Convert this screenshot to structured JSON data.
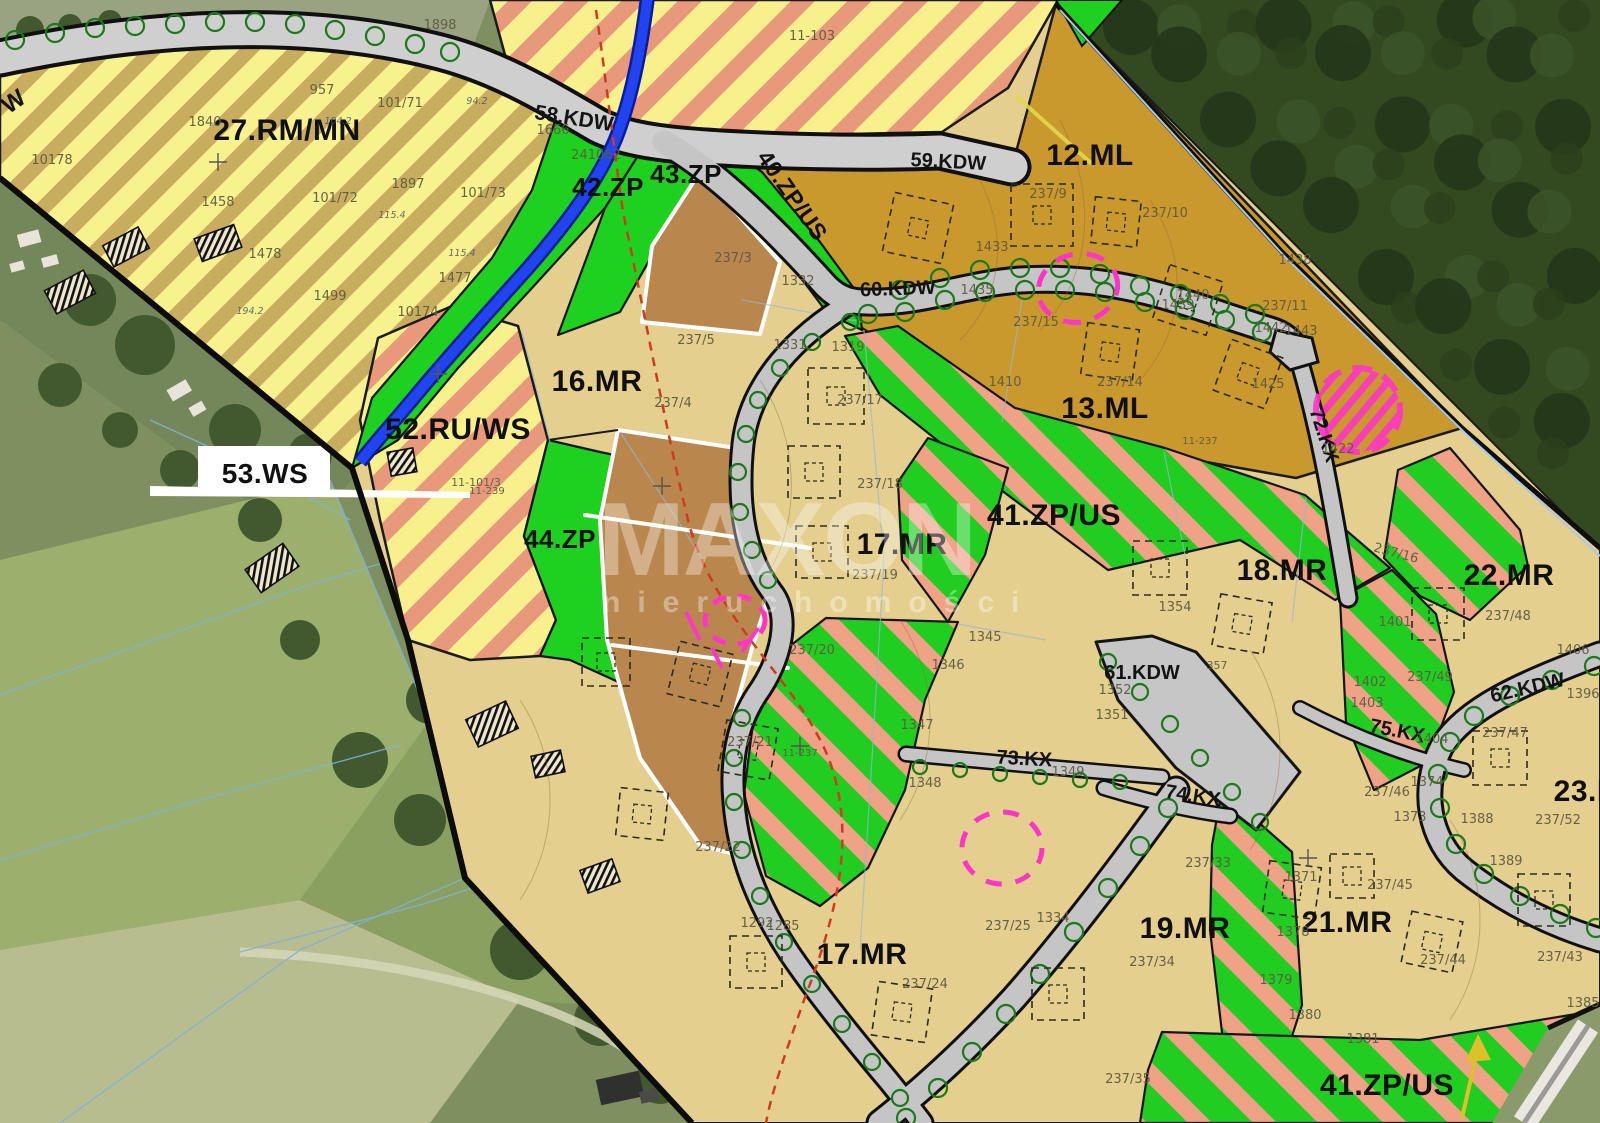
{
  "map_title": "zoning-plan-over-orthophoto",
  "watermark": {
    "line1": "MAXON",
    "line2": "nieruchomości"
  },
  "colors": {
    "zone_green": "#1fd11f",
    "stripe_salmon": "#efa285",
    "zone_yellow": "#f8f28e",
    "stripe_tan": "#c9ad5f",
    "zone_tan_mr": "#e4cf8f",
    "zone_goldenrod_ml": "#c9992e",
    "parcel_brown": "#b9874e",
    "road_gray": "#c5c5c5",
    "stream_blue": "#2244f0",
    "highlight_magenta": "#ff35c8",
    "forest_green": "#33491f",
    "boundary_black": "#0c0c0c"
  },
  "zone_labels": [
    {
      "id": "zone-27-rm-mn",
      "text": "27.RM/MN",
      "x": 287,
      "y": 140,
      "size": 30
    },
    {
      "id": "zone-12-ml",
      "text": "12.ML",
      "x": 1090,
      "y": 165,
      "size": 30
    },
    {
      "id": "zone-13-ml",
      "text": "13.ML",
      "x": 1105,
      "y": 418,
      "size": 30
    },
    {
      "id": "zone-16-mr",
      "text": "16.MR",
      "x": 597,
      "y": 391,
      "size": 30
    },
    {
      "id": "zone-17-mr",
      "text": "17.MR",
      "x": 902,
      "y": 554,
      "size": 30
    },
    {
      "id": "zone-17-mr-2",
      "text": "17.MR",
      "x": 862,
      "y": 964,
      "size": 30
    },
    {
      "id": "zone-18-mr",
      "text": "18.MR",
      "x": 1282,
      "y": 580,
      "size": 30
    },
    {
      "id": "zone-19-mr",
      "text": "19.MR",
      "x": 1185,
      "y": 938,
      "size": 30
    },
    {
      "id": "zone-21-mr",
      "text": "21.MR",
      "x": 1347,
      "y": 932,
      "size": 30
    },
    {
      "id": "zone-22-mr",
      "text": "22.MR",
      "x": 1509,
      "y": 585,
      "size": 30
    },
    {
      "id": "zone-23-m",
      "text": "23.M",
      "x": 1588,
      "y": 801,
      "size": 30
    },
    {
      "id": "zone-41-zp-us",
      "text": "41.ZP/US",
      "x": 1054,
      "y": 525,
      "size": 30
    },
    {
      "id": "zone-41-zp-us-2",
      "text": "41.ZP/US",
      "x": 1387,
      "y": 1095,
      "size": 30
    },
    {
      "id": "zone-42-zp",
      "text": "42.ZP",
      "x": 608,
      "y": 196,
      "size": 26
    },
    {
      "id": "zone-43-zp",
      "text": "43.ZP",
      "x": 686,
      "y": 183,
      "size": 26
    },
    {
      "id": "zone-40-zp-us",
      "text": "40.ZP/US",
      "x": 786,
      "y": 200,
      "size": 23,
      "rot": 55
    },
    {
      "id": "zone-44-zp",
      "text": "44.ZP",
      "x": 560,
      "y": 548,
      "size": 26
    },
    {
      "id": "zone-52-ru-ws",
      "text": "52.RU/WS",
      "x": 458,
      "y": 439,
      "size": 30
    },
    {
      "id": "zone-53-ws",
      "text": "53.WS",
      "x": 265,
      "y": 483,
      "size": 28
    }
  ],
  "road_labels": [
    {
      "id": "road-58-kdw",
      "text": "58.KDW",
      "x": 573,
      "y": 125,
      "size": 21,
      "rot": 9
    },
    {
      "id": "road-59-kdw",
      "text": "59.KDW",
      "x": 948,
      "y": 168,
      "size": 20,
      "rot": 3
    },
    {
      "id": "road-60-kdw",
      "text": "60.KDW",
      "x": 898,
      "y": 295,
      "size": 20,
      "rot": -2
    },
    {
      "id": "road-61-kdw",
      "text": "61.KDW",
      "x": 1142,
      "y": 679,
      "size": 20
    },
    {
      "id": "road-62-kdw",
      "text": "62.KDW",
      "x": 1529,
      "y": 694,
      "size": 20,
      "rot": -13
    },
    {
      "id": "road-72-kx",
      "text": "72.KX",
      "x": 1318,
      "y": 437,
      "size": 20,
      "rot": 72
    },
    {
      "id": "road-73-kx",
      "text": "73.KX",
      "x": 1024,
      "y": 765,
      "size": 20,
      "rot": 3
    },
    {
      "id": "road-74-kx",
      "text": "74.KX",
      "x": 1192,
      "y": 802,
      "size": 20,
      "rot": 9
    },
    {
      "id": "road-75-kx",
      "text": "75.KX",
      "x": 1396,
      "y": 737,
      "size": 20,
      "rot": 11
    },
    {
      "id": "road-w",
      "text": "W",
      "x": 18,
      "y": 108,
      "size": 24,
      "rot": -35
    }
  ],
  "parcel_labels": [
    {
      "text": "10178",
      "x": 52,
      "y": 164
    },
    {
      "text": "1840",
      "x": 205,
      "y": 126
    },
    {
      "text": "10174",
      "x": 418,
      "y": 316
    },
    {
      "text": "241062",
      "x": 596,
      "y": 159
    },
    {
      "text": "1898",
      "x": 440,
      "y": 29
    },
    {
      "text": "957",
      "x": 322,
      "y": 94
    },
    {
      "text": "101/71",
      "x": 400,
      "y": 107
    },
    {
      "text": "1897",
      "x": 408,
      "y": 188
    },
    {
      "text": "101/72",
      "x": 335,
      "y": 202
    },
    {
      "text": "101/73",
      "x": 483,
      "y": 197
    },
    {
      "text": "1458",
      "x": 218,
      "y": 206
    },
    {
      "text": "1478",
      "x": 265,
      "y": 258
    },
    {
      "text": "1499",
      "x": 330,
      "y": 300
    },
    {
      "text": "1477",
      "x": 455,
      "y": 282
    },
    {
      "text": "11-101/3",
      "x": 476,
      "y": 486,
      "size": 11
    },
    {
      "text": "1666",
      "x": 553,
      "y": 134
    },
    {
      "text": "11-103",
      "x": 812,
      "y": 40
    },
    {
      "text": "237/3",
      "x": 733,
      "y": 262
    },
    {
      "text": "237/5",
      "x": 696,
      "y": 344
    },
    {
      "text": "237/4",
      "x": 673,
      "y": 407
    },
    {
      "text": "11-239",
      "x": 487,
      "y": 494,
      "size": 10
    },
    {
      "text": "237/9",
      "x": 1048,
      "y": 198
    },
    {
      "text": "237/10",
      "x": 1165,
      "y": 217
    },
    {
      "text": "1433",
      "x": 992,
      "y": 251
    },
    {
      "text": "1435",
      "x": 977,
      "y": 294
    },
    {
      "text": "1438",
      "x": 1295,
      "y": 264
    },
    {
      "text": "1440",
      "x": 1193,
      "y": 299
    },
    {
      "text": "1439",
      "x": 1178,
      "y": 309
    },
    {
      "text": "237/11",
      "x": 1285,
      "y": 310
    },
    {
      "text": "1442",
      "x": 1271,
      "y": 332
    },
    {
      "text": "1443",
      "x": 1301,
      "y": 335
    },
    {
      "text": "1425",
      "x": 1268,
      "y": 388
    },
    {
      "text": "237/14",
      "x": 1120,
      "y": 386
    },
    {
      "text": "237/15",
      "x": 1036,
      "y": 326
    },
    {
      "text": "1410",
      "x": 1005,
      "y": 386
    },
    {
      "text": "11-237",
      "x": 1200,
      "y": 444,
      "size": 10
    },
    {
      "text": "1422",
      "x": 1338,
      "y": 453
    },
    {
      "text": "1319",
      "x": 848,
      "y": 351
    },
    {
      "text": "1332",
      "x": 798,
      "y": 285
    },
    {
      "text": "1331",
      "x": 790,
      "y": 349
    },
    {
      "text": "237/17",
      "x": 860,
      "y": 404
    },
    {
      "text": "237/18",
      "x": 880,
      "y": 488
    },
    {
      "text": "237/19",
      "x": 875,
      "y": 579
    },
    {
      "text": "237/20",
      "x": 812,
      "y": 654
    },
    {
      "text": "237/21",
      "x": 750,
      "y": 746
    },
    {
      "text": "11-237",
      "x": 800,
      "y": 756,
      "size": 10
    },
    {
      "text": "237/22",
      "x": 718,
      "y": 851
    },
    {
      "text": "1345",
      "x": 985,
      "y": 641
    },
    {
      "text": "1346",
      "x": 948,
      "y": 669
    },
    {
      "text": "1347",
      "x": 917,
      "y": 729
    },
    {
      "text": "1348",
      "x": 925,
      "y": 787
    },
    {
      "text": "1349",
      "x": 1068,
      "y": 776
    },
    {
      "text": "1352",
      "x": 1115,
      "y": 694
    },
    {
      "text": "1351",
      "x": 1112,
      "y": 719
    },
    {
      "text": "357",
      "x": 1217,
      "y": 669,
      "size": 11
    },
    {
      "text": "1354",
      "x": 1175,
      "y": 611
    },
    {
      "text": "237/16",
      "x": 1395,
      "y": 557,
      "rot": 15
    },
    {
      "text": "1401",
      "x": 1395,
      "y": 626
    },
    {
      "text": "1402",
      "x": 1370,
      "y": 686
    },
    {
      "text": "1403",
      "x": 1367,
      "y": 707
    },
    {
      "text": "1404",
      "x": 1432,
      "y": 743
    },
    {
      "text": "237/49",
      "x": 1430,
      "y": 681
    },
    {
      "text": "237/48",
      "x": 1508,
      "y": 620
    },
    {
      "text": "237/47",
      "x": 1505,
      "y": 737
    },
    {
      "text": "1406",
      "x": 1573,
      "y": 654
    },
    {
      "text": "1396",
      "x": 1583,
      "y": 698
    },
    {
      "text": "237/52",
      "x": 1558,
      "y": 824
    },
    {
      "text": "1389",
      "x": 1506,
      "y": 865
    },
    {
      "text": "1388",
      "x": 1477,
      "y": 823
    },
    {
      "text": "1374",
      "x": 1427,
      "y": 786
    },
    {
      "text": "1373",
      "x": 1410,
      "y": 821
    },
    {
      "text": "237/46",
      "x": 1387,
      "y": 796
    },
    {
      "text": "237/45",
      "x": 1390,
      "y": 889
    },
    {
      "text": "237/44",
      "x": 1443,
      "y": 964
    },
    {
      "text": "237/43",
      "x": 1560,
      "y": 961
    },
    {
      "text": "1385",
      "x": 1583,
      "y": 1007
    },
    {
      "text": "1380",
      "x": 1305,
      "y": 1019
    },
    {
      "text": "1381",
      "x": 1363,
      "y": 1043
    },
    {
      "text": "1379",
      "x": 1276,
      "y": 984
    },
    {
      "text": "237/33",
      "x": 1208,
      "y": 867
    },
    {
      "text": "237/34",
      "x": 1152,
      "y": 966
    },
    {
      "text": "237/35",
      "x": 1128,
      "y": 1083
    },
    {
      "text": "1371",
      "x": 1301,
      "y": 881
    },
    {
      "text": "1378",
      "x": 1293,
      "y": 936
    },
    {
      "text": "1292",
      "x": 757,
      "y": 927
    },
    {
      "text": "1285",
      "x": 783,
      "y": 930
    },
    {
      "text": "237/24",
      "x": 925,
      "y": 988
    },
    {
      "text": "237/25",
      "x": 1008,
      "y": 930
    },
    {
      "text": "1334",
      "x": 1053,
      "y": 922
    }
  ],
  "measure_labels": [
    {
      "text": "115.4",
      "x": 392,
      "y": 218
    },
    {
      "text": "115.4",
      "x": 462,
      "y": 256
    },
    {
      "text": "94.2",
      "x": 477,
      "y": 104
    },
    {
      "text": "194.2",
      "x": 250,
      "y": 314
    },
    {
      "text": "104.2",
      "x": 338,
      "y": 124
    }
  ]
}
